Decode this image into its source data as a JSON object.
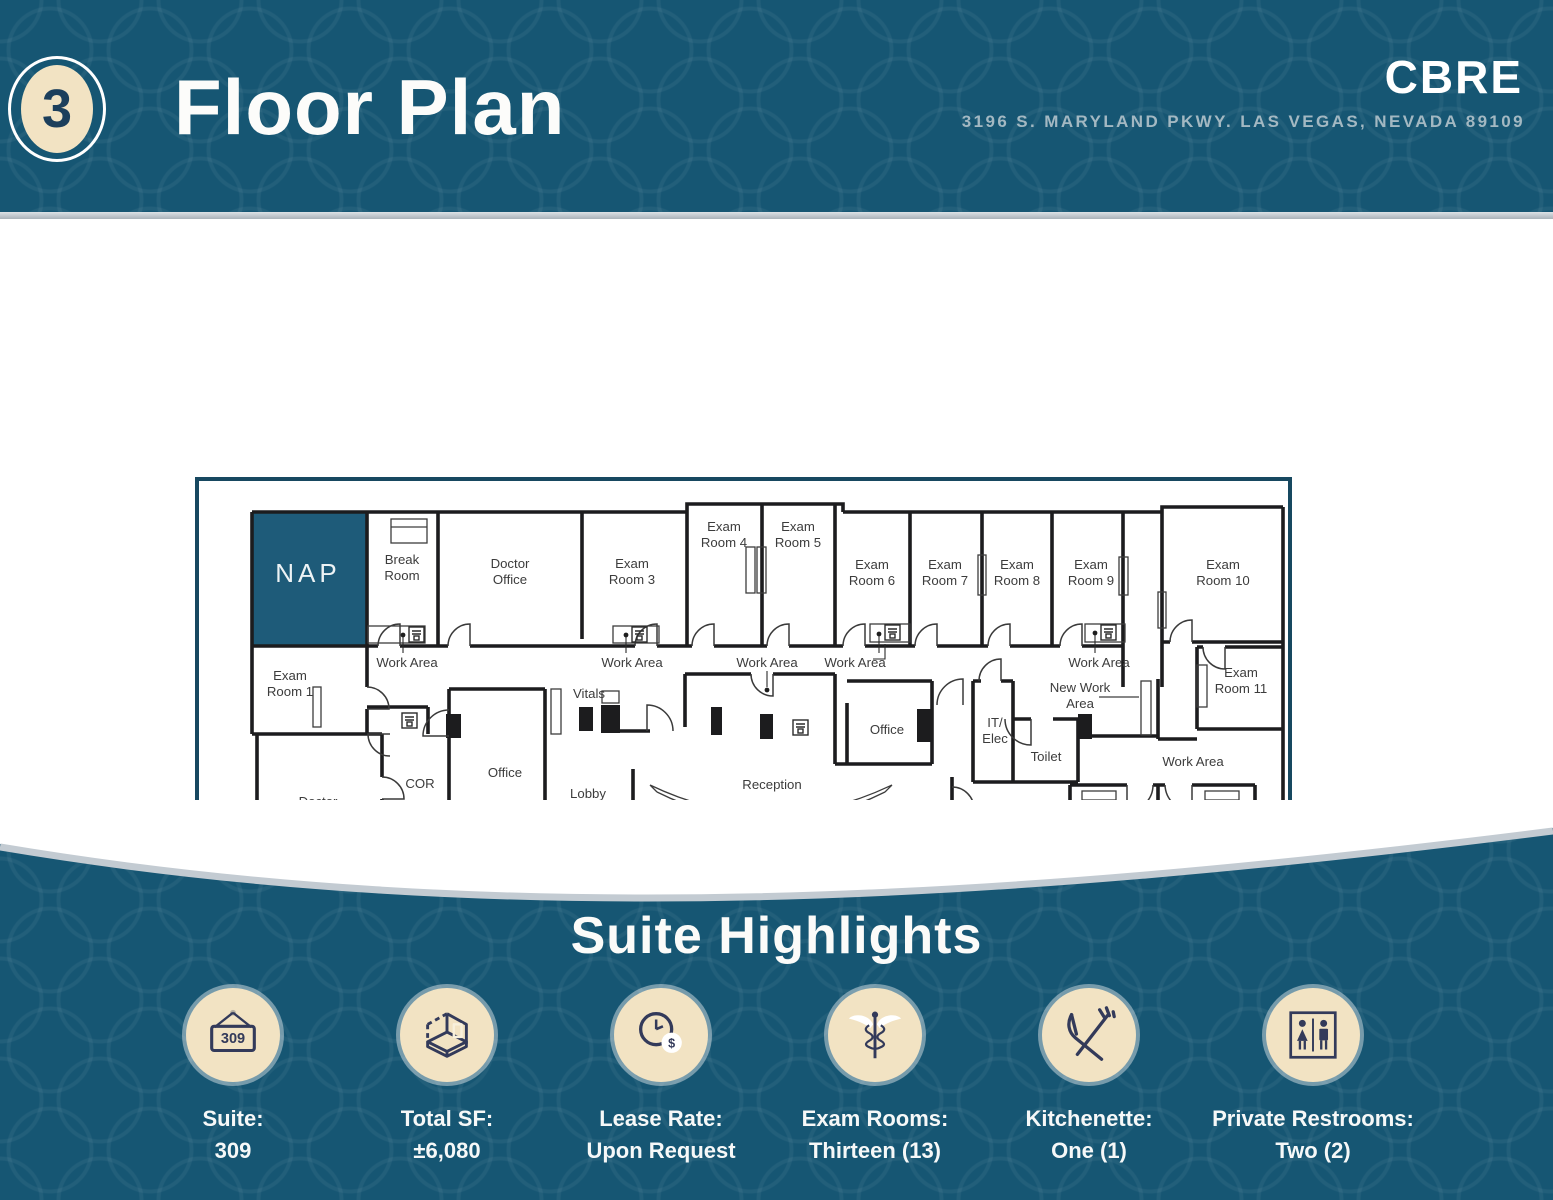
{
  "header": {
    "page_number": "3",
    "title": "Floor Plan",
    "logo": "CBRE",
    "address": "3196 S. MARYLAND PKWY. LAS VEGAS, NEVADA 89109"
  },
  "colors": {
    "teal": "#165673",
    "nap": "#1E5B79",
    "cream": "#F2E3C3",
    "navy": "#333A5A",
    "silver": "#C3CBD2",
    "wall": "#1C1C1E",
    "frame": "#174860"
  },
  "floor_plan": {
    "labels": [
      {
        "lines": [
          "NAP"
        ],
        "x": 113,
        "y": 96,
        "variant": "nap"
      },
      {
        "lines": [
          "Break",
          "Room"
        ],
        "x": 207,
        "y": 90
      },
      {
        "lines": [
          "Doctor",
          "Office"
        ],
        "x": 315,
        "y": 94
      },
      {
        "lines": [
          "Exam",
          "Room 3"
        ],
        "x": 437,
        "y": 94
      },
      {
        "lines": [
          "Exam",
          "Room 4"
        ],
        "x": 529,
        "y": 57
      },
      {
        "lines": [
          "Exam",
          "Room 5"
        ],
        "x": 603,
        "y": 57
      },
      {
        "lines": [
          "Exam",
          "Room 6"
        ],
        "x": 677,
        "y": 95
      },
      {
        "lines": [
          "Exam",
          "Room 7"
        ],
        "x": 750,
        "y": 95
      },
      {
        "lines": [
          "Exam",
          "Room 8"
        ],
        "x": 822,
        "y": 95
      },
      {
        "lines": [
          "Exam",
          "Room 9"
        ],
        "x": 896,
        "y": 95
      },
      {
        "lines": [
          "Exam",
          "Room 10"
        ],
        "x": 1028,
        "y": 95
      },
      {
        "lines": [
          "Exam",
          "Room 1"
        ],
        "x": 95,
        "y": 206
      },
      {
        "lines": [
          "Exam",
          "Room 11"
        ],
        "x": 1046,
        "y": 203
      },
      {
        "lines": [
          "Work Area"
        ],
        "x": 212,
        "y": 185,
        "variant": "area"
      },
      {
        "lines": [
          "Work Area"
        ],
        "x": 437,
        "y": 185,
        "variant": "area"
      },
      {
        "lines": [
          "Work Area"
        ],
        "x": 572,
        "y": 185,
        "variant": "area"
      },
      {
        "lines": [
          "Work Area"
        ],
        "x": 660,
        "y": 185,
        "variant": "area"
      },
      {
        "lines": [
          "Work Area"
        ],
        "x": 904,
        "y": 185,
        "variant": "area"
      },
      {
        "lines": [
          "Work Area"
        ],
        "x": 998,
        "y": 284,
        "variant": "area"
      },
      {
        "lines": [
          "Vitals"
        ],
        "x": 394,
        "y": 216
      },
      {
        "lines": [
          "New Work",
          "Area"
        ],
        "x": 885,
        "y": 218
      },
      {
        "lines": [
          "IT/",
          "Elec"
        ],
        "x": 800,
        "y": 253
      },
      {
        "lines": [
          "Toilet"
        ],
        "x": 851,
        "y": 279
      },
      {
        "lines": [
          "Office"
        ],
        "x": 692,
        "y": 252
      },
      {
        "lines": [
          "Office"
        ],
        "x": 310,
        "y": 295
      },
      {
        "lines": [
          "COR"
        ],
        "x": 225,
        "y": 306
      },
      {
        "lines": [
          "Lobby"
        ],
        "x": 393,
        "y": 316
      },
      {
        "lines": [
          "Reception"
        ],
        "x": 577,
        "y": 307
      },
      {
        "lines": [
          "Lobby"
        ],
        "x": 577,
        "y": 389
      },
      {
        "lines": [
          "Lobby"
        ],
        "x": 818,
        "y": 353
      },
      {
        "lines": [
          "Doctor",
          "Open Office"
        ],
        "x": 123,
        "y": 332
      },
      {
        "lines": [
          "Exam",
          "Rm 13"
        ],
        "x": 923,
        "y": 356
      },
      {
        "lines": [
          "Exam",
          "Rm 12"
        ],
        "x": 1020,
        "y": 356
      },
      {
        "lines": [
          "NAP"
        ],
        "x": 250,
        "y": 474,
        "variant": "nap"
      },
      {
        "lines": [
          "NAP"
        ],
        "x": 898,
        "y": 466,
        "variant": "nap"
      }
    ]
  },
  "highlights": {
    "title": "Suite Highlights",
    "items": [
      {
        "icon": "suite-sign-icon",
        "sign_text": "309",
        "label": "Suite:",
        "value": "309"
      },
      {
        "icon": "floor-area-icon",
        "label": "Total SF:",
        "value": "±6,080"
      },
      {
        "icon": "lease-clock-icon",
        "label": "Lease Rate:",
        "value": "Upon Request"
      },
      {
        "icon": "caduceus-icon",
        "label": "Exam Rooms:",
        "value": "Thirteen (13)"
      },
      {
        "icon": "utensils-icon",
        "label": "Kitchenette:",
        "value": "One (1)"
      },
      {
        "icon": "restrooms-icon",
        "label": "Private Restrooms:",
        "value": "Two (2)"
      }
    ]
  }
}
